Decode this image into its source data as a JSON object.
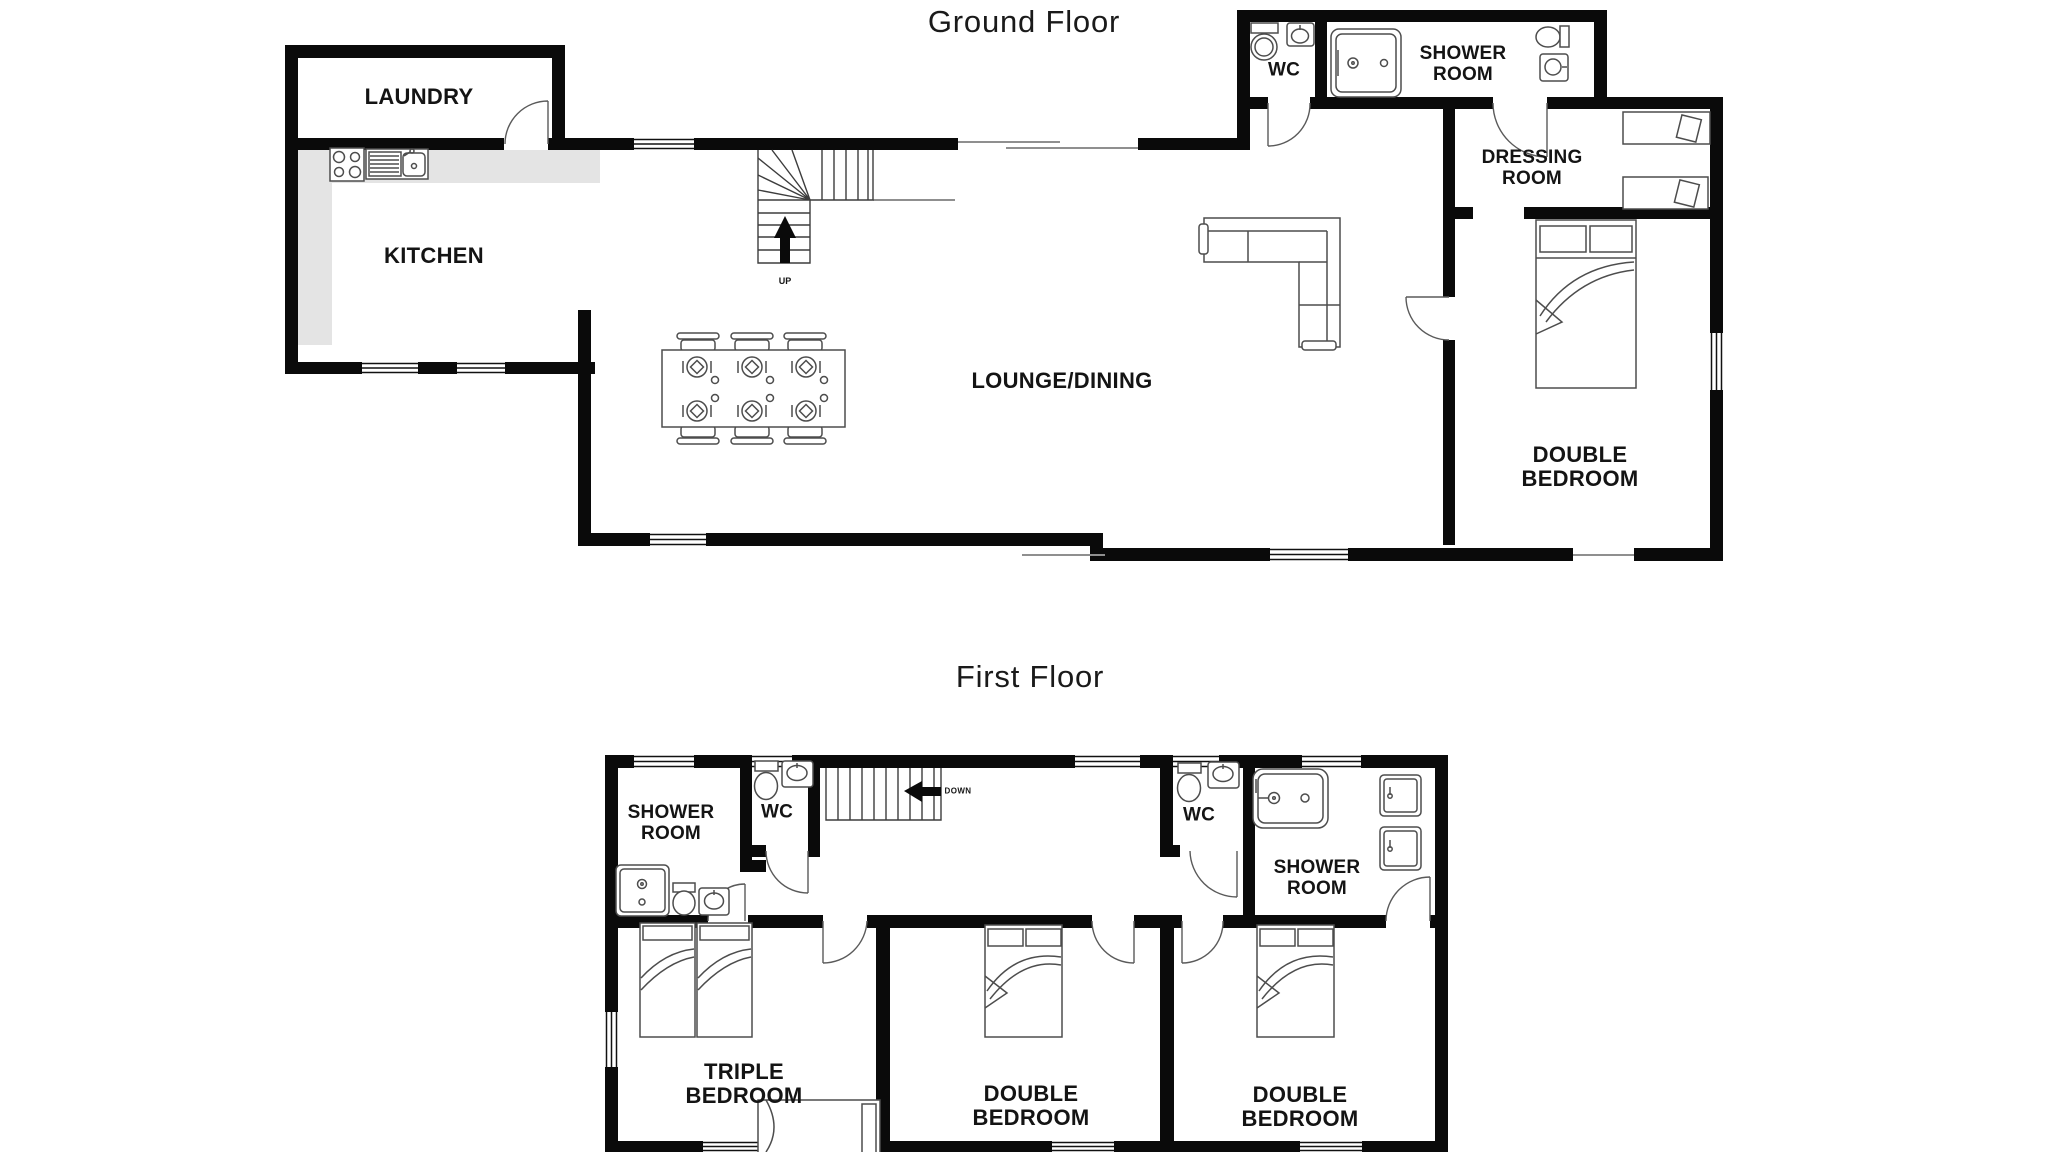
{
  "colors": {
    "wall": "#0a0a0a",
    "counter": "#e4e4e4",
    "fixture_stroke": "#4d4d4d",
    "label": "#141414",
    "background": "#ffffff"
  },
  "ground_floor": {
    "title": "Ground Floor",
    "stairs_label": "UP",
    "rooms": {
      "laundry": {
        "label": "LAUNDRY"
      },
      "kitchen": {
        "label": "KITCHEN"
      },
      "wc": {
        "label": "WC"
      },
      "shower_room": {
        "line1": "SHOWER",
        "line2": "ROOM"
      },
      "dressing_room": {
        "line1": "DRESSING",
        "line2": "ROOM"
      },
      "lounge_dining": {
        "label": "LOUNGE/DINING"
      },
      "double_bedroom": {
        "line1": "DOUBLE",
        "line2": "BEDROOM"
      }
    }
  },
  "first_floor": {
    "title": "First Floor",
    "stairs_label": "DOWN",
    "rooms": {
      "shower_room_left": {
        "line1": "SHOWER",
        "line2": "ROOM"
      },
      "wc_left": {
        "label": "WC"
      },
      "wc_right": {
        "label": "WC"
      },
      "shower_room_right": {
        "line1": "SHOWER",
        "line2": "ROOM"
      },
      "triple_bedroom": {
        "line1": "TRIPLE",
        "line2": "BEDROOM"
      },
      "double_bedroom_left": {
        "line1": "DOUBLE",
        "line2": "BEDROOM"
      },
      "double_bedroom_right": {
        "line1": "DOUBLE",
        "line2": "BEDROOM"
      }
    }
  }
}
